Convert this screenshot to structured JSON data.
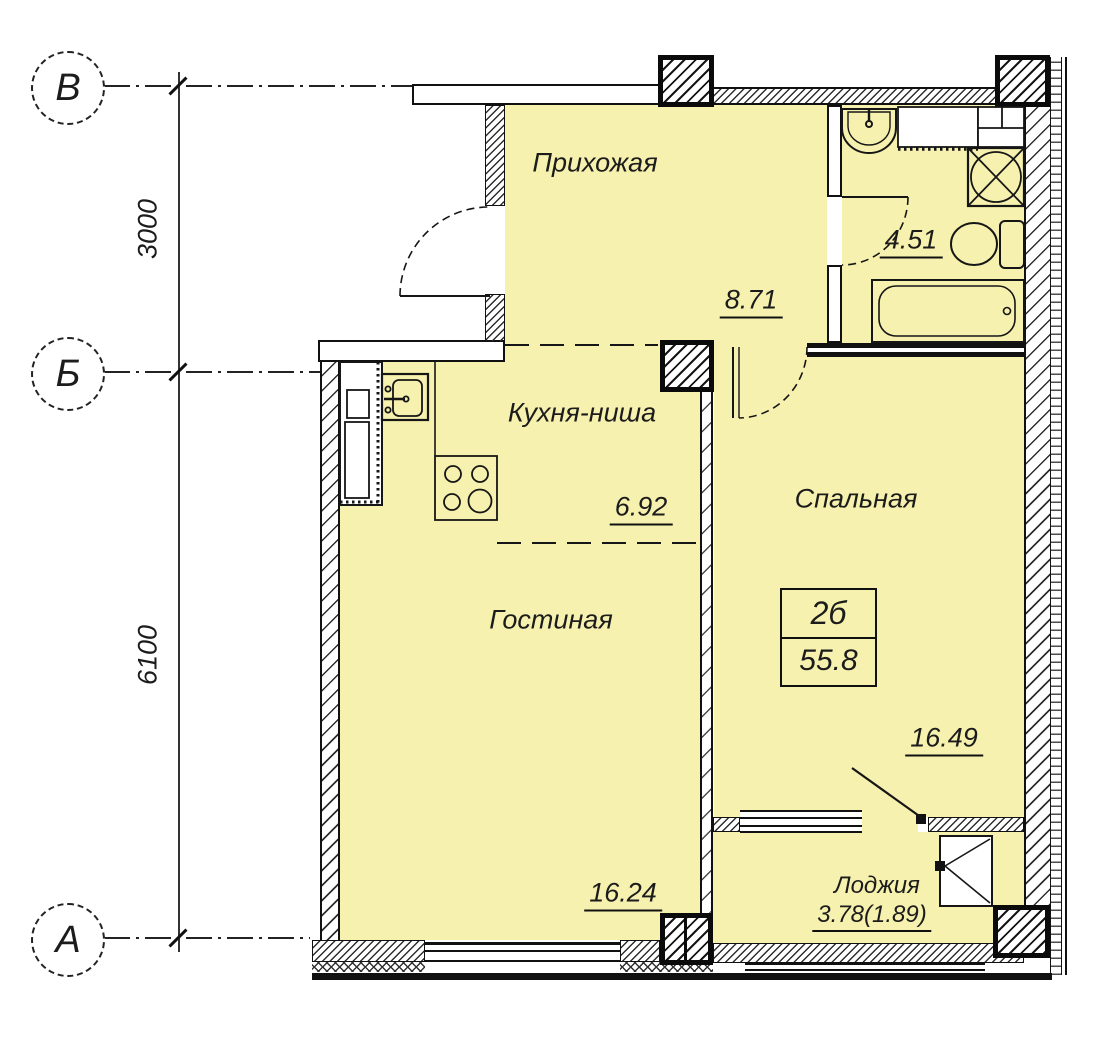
{
  "plan": {
    "rooms": [
      {
        "id": "hallway",
        "label": "Прихожая",
        "area": "8.71"
      },
      {
        "id": "bathroom",
        "label": "",
        "area": "4.51"
      },
      {
        "id": "kitchen_niche",
        "label": "Кухня-ниша",
        "area": "6.92"
      },
      {
        "id": "bedroom",
        "label": "Спальная",
        "area": "16.49"
      },
      {
        "id": "living_room",
        "label": "Гостиная",
        "area": "16.24"
      },
      {
        "id": "loggia",
        "label": "Лоджия",
        "area": "3.78(1.89)"
      }
    ],
    "apartment": {
      "type": "2б",
      "total_area": "55.8"
    },
    "axes": {
      "rows": [
        {
          "label": "В"
        },
        {
          "label": "Б"
        },
        {
          "label": "А"
        }
      ],
      "dimensions": [
        {
          "value": "3000"
        },
        {
          "value": "6100"
        }
      ]
    },
    "colors": {
      "room_fill": "#f6f1ae",
      "line": "#111111"
    },
    "fixtures": [
      "washbasin",
      "washing-machine",
      "shower",
      "toilet",
      "bathtub",
      "kitchen-sink",
      "stove-4-burner",
      "ventilation-shaft",
      "entrance-door",
      "interior-door",
      "window",
      "loggia-window"
    ]
  }
}
